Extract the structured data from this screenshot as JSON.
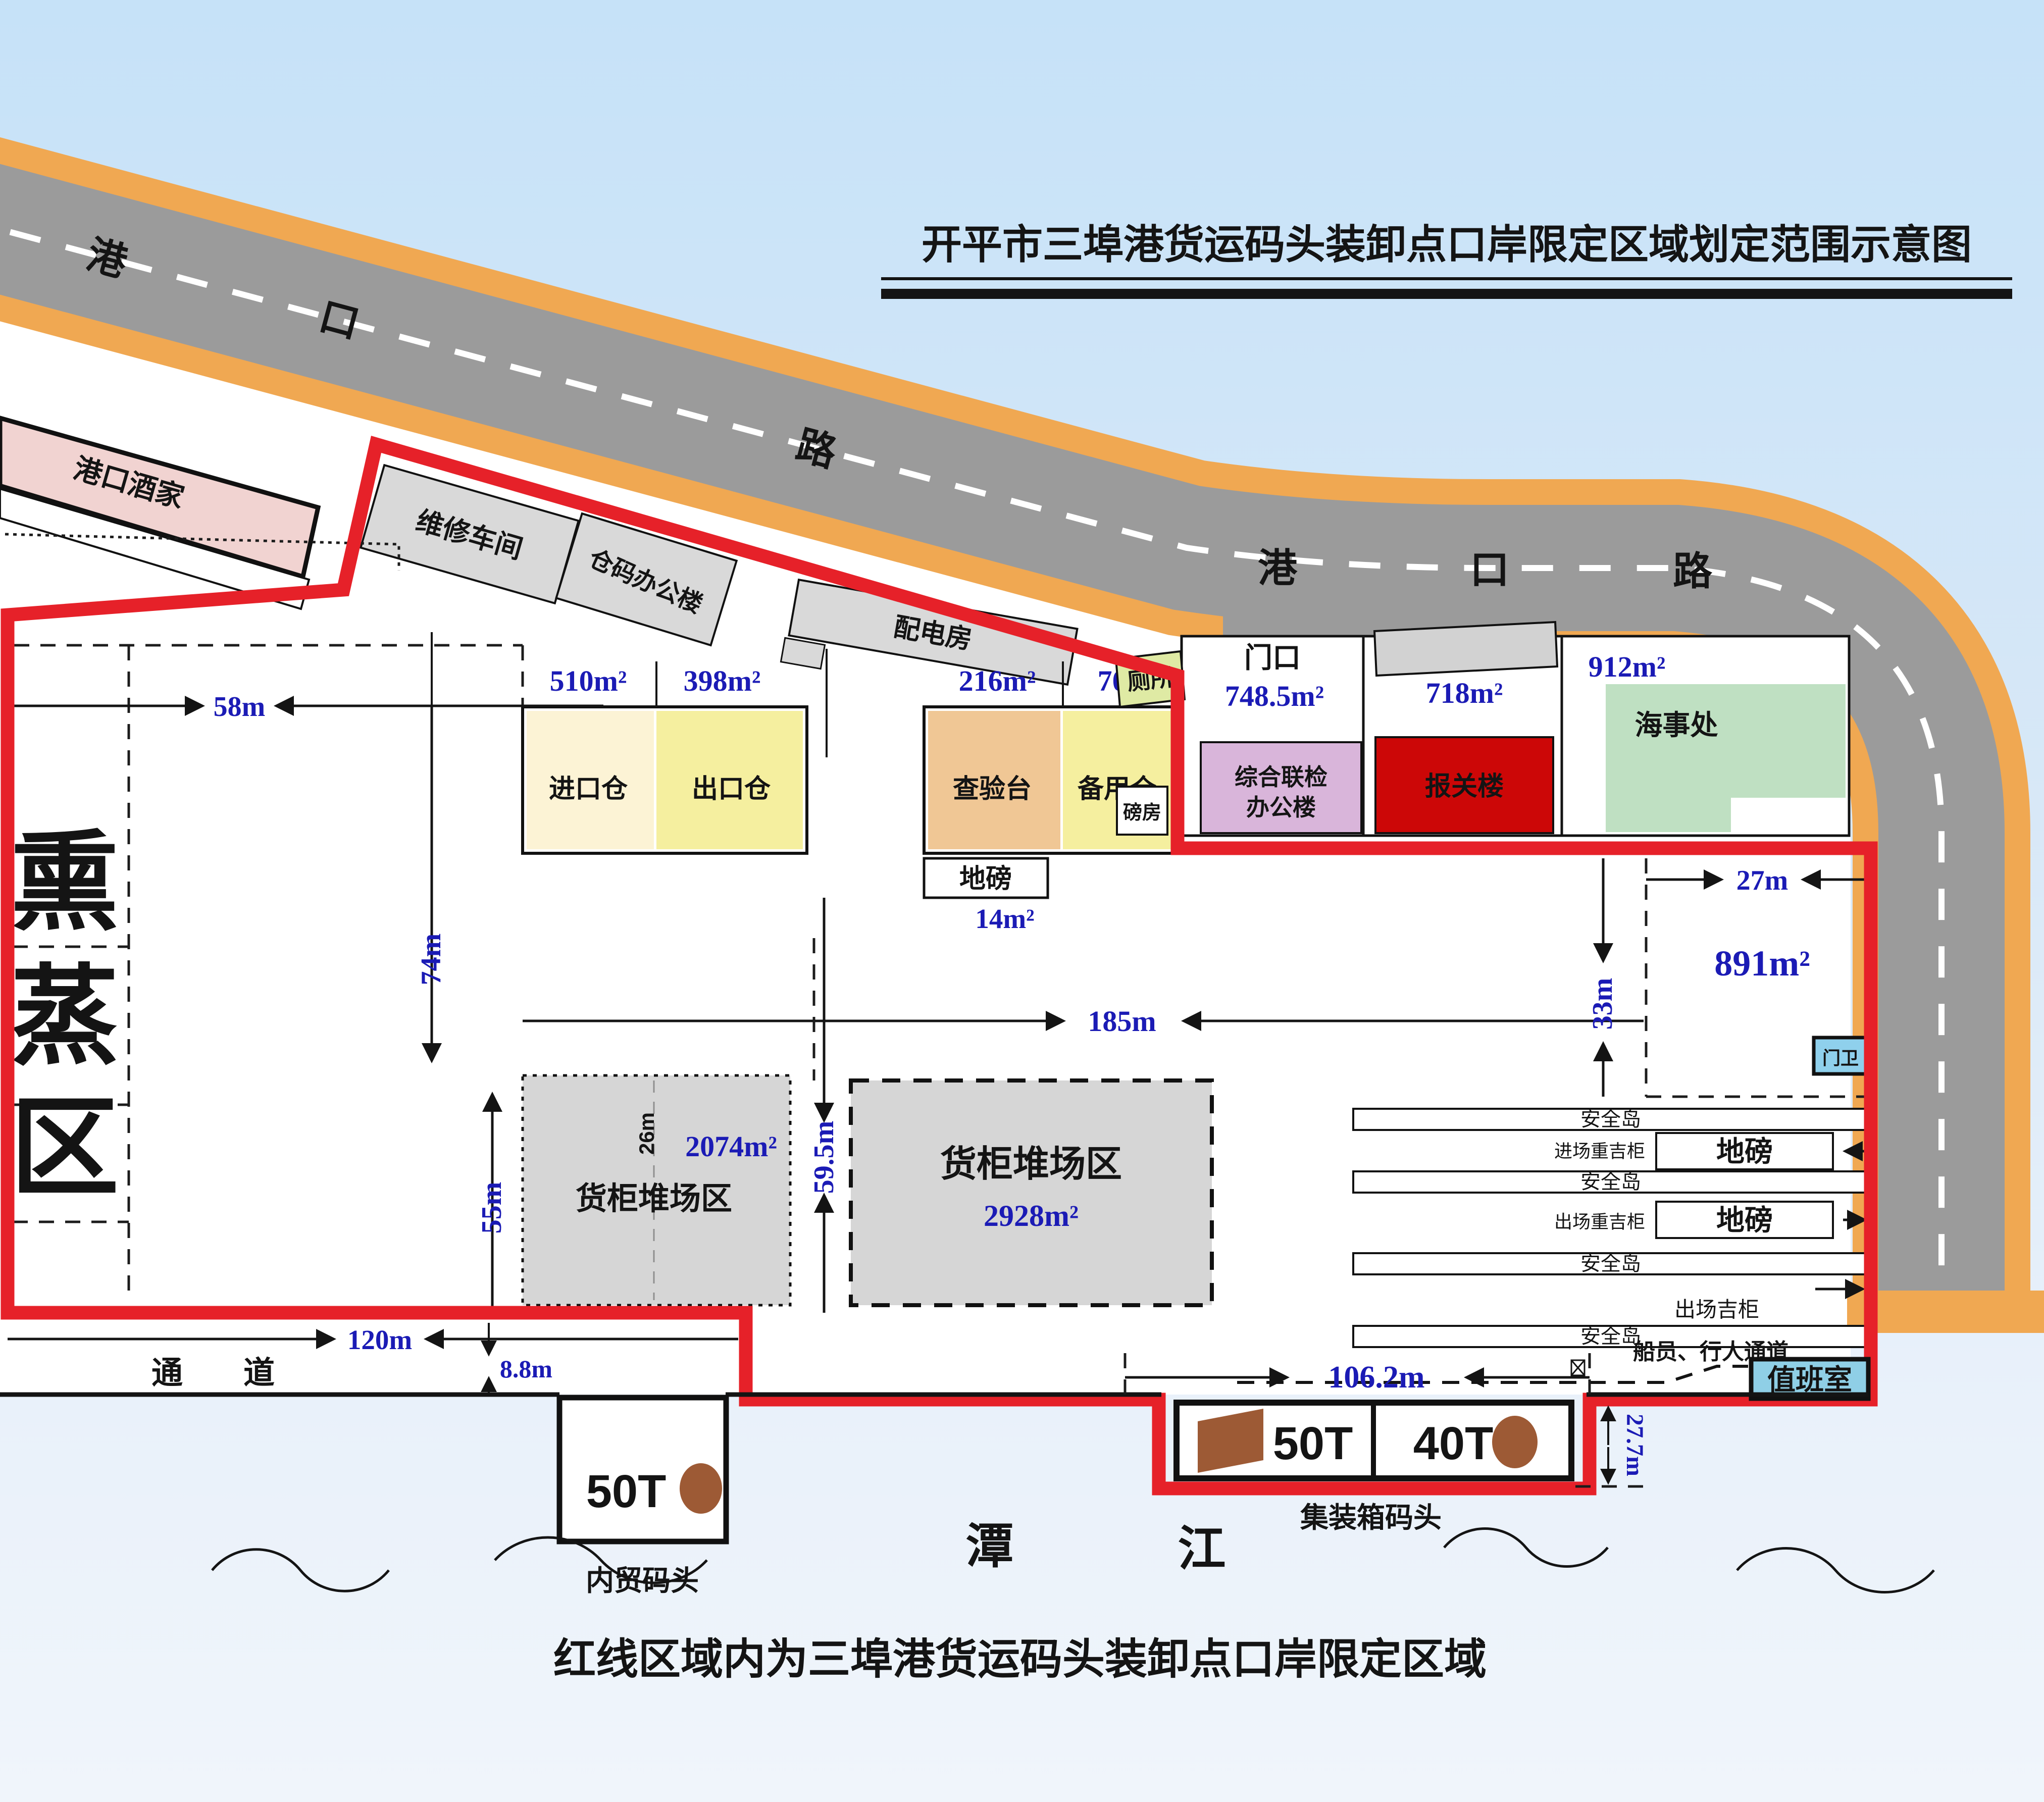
{
  "title": "开平市三埠港货运码头装卸点口岸限定区域划定范围示意图",
  "caption": "红线区域内为三埠港货运码头装卸点口岸限定区域",
  "accent_colors": {
    "red_boundary": "#e62129",
    "road_gray": "#9b9b9b",
    "curb_orange": "#f0a852",
    "dim_blue": "#1b1bb5"
  },
  "road": {
    "name1": [
      "港",
      "口",
      "路"
    ],
    "name2": [
      "港",
      "口",
      "路"
    ]
  },
  "outside": {
    "restaurant": "港口酒家",
    "repair_shop": "维修车间",
    "warehouse_office": "仓码办公楼",
    "power_room": "配电房",
    "toilet": "厕所",
    "gate": "门口",
    "gate_area": "748.5m²",
    "weigh_room": "磅房",
    "joint_office_line1": "综合联检",
    "joint_office_line2": "办公楼",
    "customs": "报关楼",
    "customs_area": "718m²",
    "maritime": "海事处",
    "maritime_area": "912m²"
  },
  "port": {
    "fumigation": [
      "熏",
      "蒸",
      "区"
    ],
    "import_wh": "进口仓",
    "import_area": "510m²",
    "export_wh": "出口仓",
    "export_area": "398m²",
    "inspect": "查验台",
    "inspect_area": "216m²",
    "spare_wh": "备用仓",
    "spare_area": "705m²",
    "weighbridge": "地磅",
    "weighbridge_area": "14m²",
    "yard_left_name": "货柜堆场区",
    "yard_left_area": "2074m²",
    "yard_left_width": "26m",
    "yard_right_name": "货柜堆场区",
    "yard_right_area": "2928m²",
    "area_891": "891m²",
    "guard": "门卫",
    "passage": "通道"
  },
  "lanes": {
    "island": "安全岛",
    "in_heavy": "进场重吉柜",
    "out_heavy": "出场重吉柜",
    "out_empty": "出场吉柜",
    "scale": "地磅",
    "ped": "船员、行人通道",
    "duty": "值班室"
  },
  "wharf": {
    "domestic_t50": "50T",
    "domestic_name": "内贸码头",
    "container_t50": "50T",
    "container_t40": "40T",
    "container_name": "集装箱码头",
    "river": [
      "潭",
      "江"
    ]
  },
  "dims": {
    "d58": "58m",
    "d74": "74m",
    "d55": "55m",
    "d120": "120m",
    "d88": "8.8m",
    "d185": "185m",
    "d595": "59.5m",
    "d27": "27m",
    "d33": "33m",
    "d1062": "106.2m",
    "d277": "27.7m"
  }
}
